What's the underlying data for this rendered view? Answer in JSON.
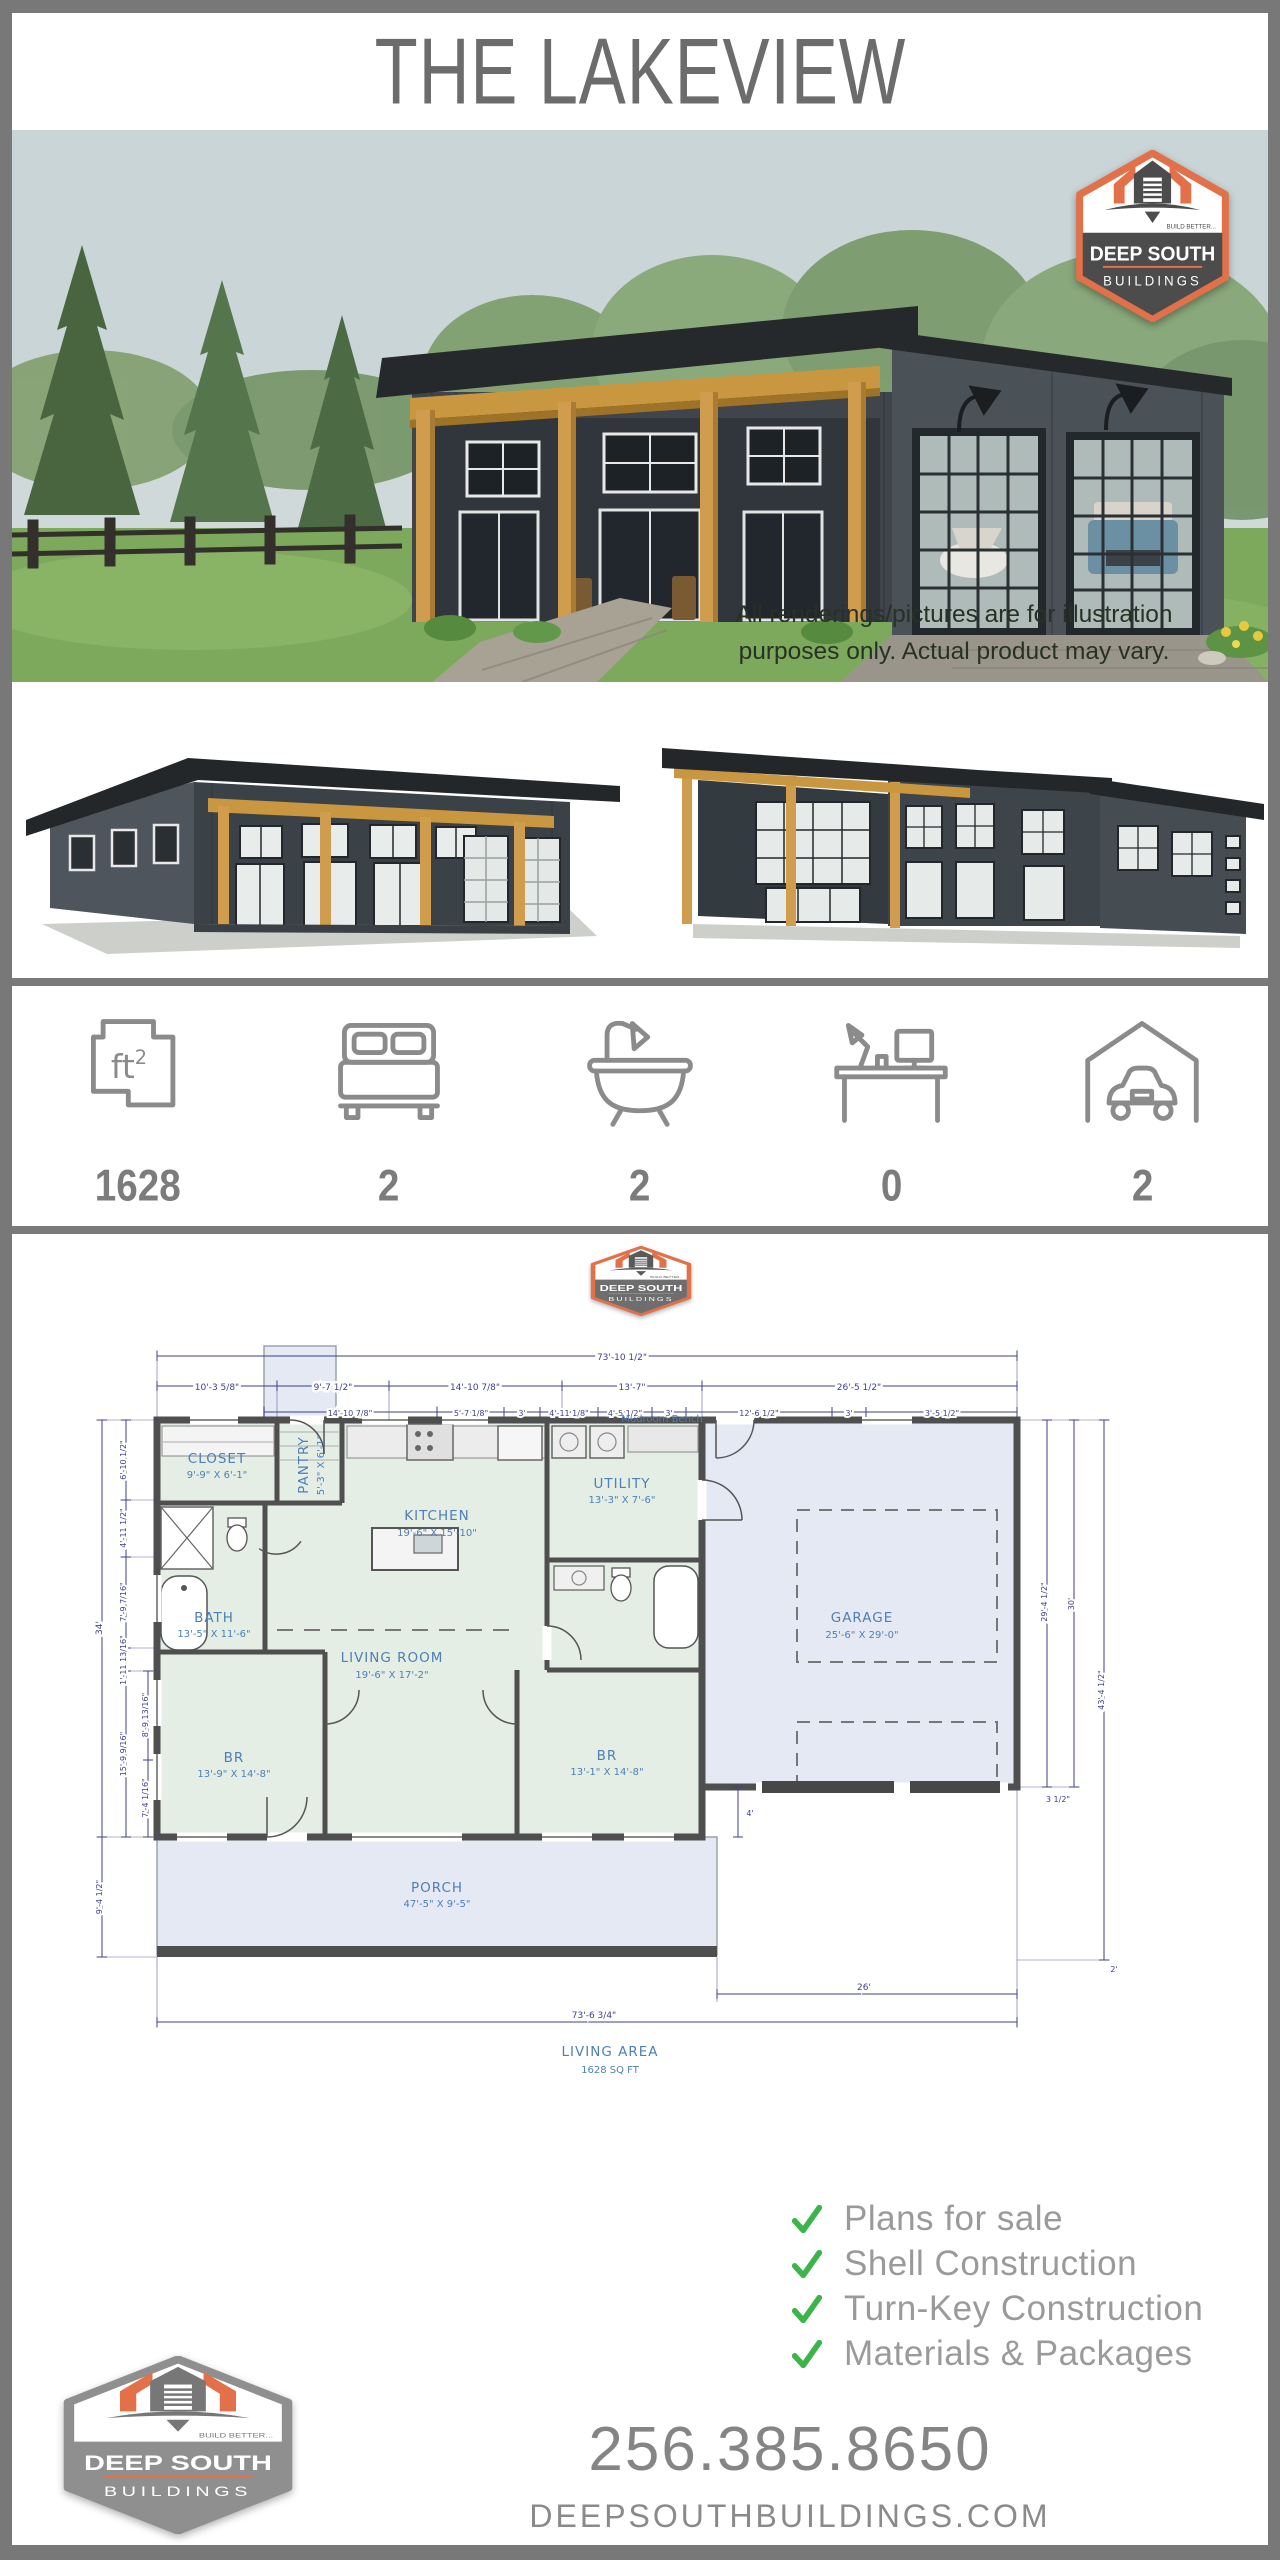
{
  "title": "THE LAKEVIEW",
  "brand": {
    "line1": "DEEP SOUTH",
    "line2": "BUILDINGS",
    "tagline": "BUILD BETTER...",
    "phone": "256.385.8650",
    "website": "DEEPSOUTHBUILDINGS.COM",
    "accent_orange": "#e2714a",
    "badge_dark": "#4c4c4c",
    "badge_gray": "#8f8f8f"
  },
  "hero": {
    "disclaimer1": "All renderings/pictures are for illustration",
    "disclaimer2": "purposes only. Actual product may vary."
  },
  "stats": {
    "area": {
      "icon": "sqft-floorplan-icon",
      "value": "1628"
    },
    "beds": {
      "icon": "bed-icon",
      "value": "2"
    },
    "baths": {
      "icon": "bathtub-icon",
      "value": "2"
    },
    "office": {
      "icon": "desk-icon",
      "value": "0"
    },
    "garage": {
      "icon": "garage-car-icon",
      "value": "2"
    }
  },
  "plan": {
    "rooms": {
      "closet": {
        "name": "CLOSET",
        "size": "9'-9\" X 6'-1\""
      },
      "pantry": {
        "name": "PANTRY",
        "size": "5'-3\" X 6'-1\""
      },
      "kitchen": {
        "name": "KITCHEN",
        "size": "19'-6\" X 15'-10\""
      },
      "utility": {
        "name": "UTILITY",
        "size": "13'-3\" X 7'-6\""
      },
      "bath": {
        "name": "BATH",
        "size": "13'-5\" X 11'-6\""
      },
      "living": {
        "name": "LIVING ROOM",
        "size": "19'-6\" X 17'-2\""
      },
      "br1": {
        "name": "BR",
        "size": "13'-9\" X 14'-8\""
      },
      "br2": {
        "name": "BR",
        "size": "13'-1\" X 14'-8\""
      },
      "garage": {
        "name": "GARAGE",
        "size": "25'-6\" X 29'-0\""
      },
      "porch": {
        "name": "PORCH",
        "size": "47'-5\" X 9'-5\""
      }
    },
    "notes": {
      "bench": "Mudroom Bench",
      "area_label": "LIVING AREA",
      "area_value": "1628 SQ FT"
    },
    "dims": {
      "overall_top": "73'-10 1/2\"",
      "row2": [
        "10'-3 5/8\"",
        "9'-7 1/2\"",
        "14'-10 7/8\"",
        "13'-7\"",
        "26'-5 1/2\""
      ],
      "row3": [
        "14'-10 7/8\"",
        "5'-7 1/8\"",
        "3'",
        "4'-11 1/8\"",
        "4'-5 1/2\"",
        "3'",
        "12'-6 1/2\"",
        "3'",
        "3'-5 1/2\""
      ],
      "left": [
        "34'",
        "6'-10 1/2\"",
        "4'-11 1/2\"",
        "7'-9 7/16\"",
        "1'-11 13/16\"",
        "15'-9 9/16\"",
        "8'-9 13/16\"",
        "7'-4 1/16\"",
        "9'-4 1/2\""
      ],
      "right": [
        "29'-4 1/2\"",
        "30'",
        "43'-4 1/2\"",
        "3 1/2\"",
        "2'"
      ],
      "bottom": [
        "4'",
        "26'",
        "73'-6 3/4\""
      ]
    }
  },
  "services": {
    "check_color": "#3bb54a",
    "items": [
      "Plans for sale",
      "Shell Construction",
      "Turn-Key Construction",
      "Materials & Packages"
    ]
  }
}
